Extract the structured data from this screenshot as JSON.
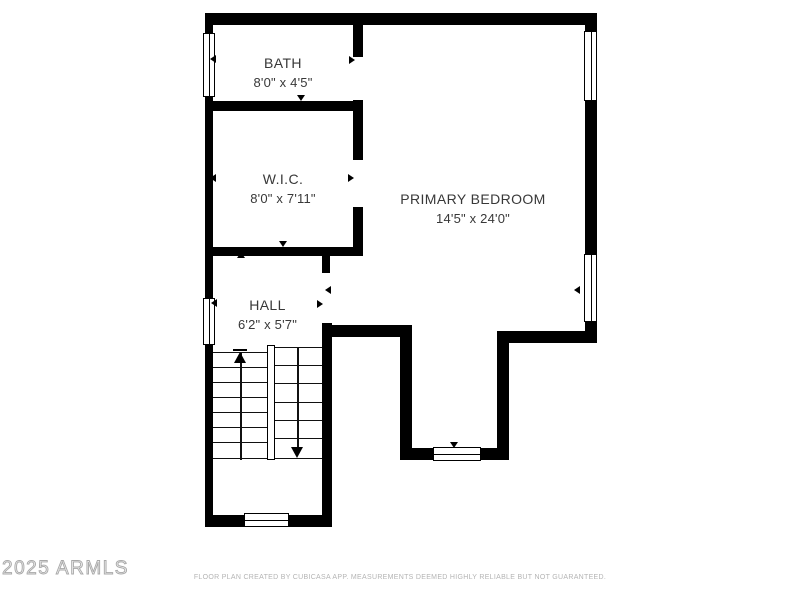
{
  "rooms": {
    "bath": {
      "name": "BATH",
      "dims": "8'0\" x 4'5\""
    },
    "wic": {
      "name": "W.I.C.",
      "dims": "8'0\" x 7'11\""
    },
    "bedroom": {
      "name": "PRIMARY BEDROOM",
      "dims": "14'5\" x 24'0\""
    },
    "hall": {
      "name": "HALL",
      "dims": "6'2\" x 5'7\""
    }
  },
  "footer": {
    "disclaimer": "FLOOR PLAN CREATED BY CUBICASA APP. MEASUREMENTS DEEMED HIGHLY RELIABLE BUT NOT GUARANTEED."
  },
  "watermark": {
    "text": "2025 ARMLS"
  },
  "colors": {
    "wall": "#000000",
    "label_text": "#383838",
    "footer_text": "#b4b4b4",
    "watermark_outline": "#a8a8a8",
    "background": "#ffffff"
  }
}
